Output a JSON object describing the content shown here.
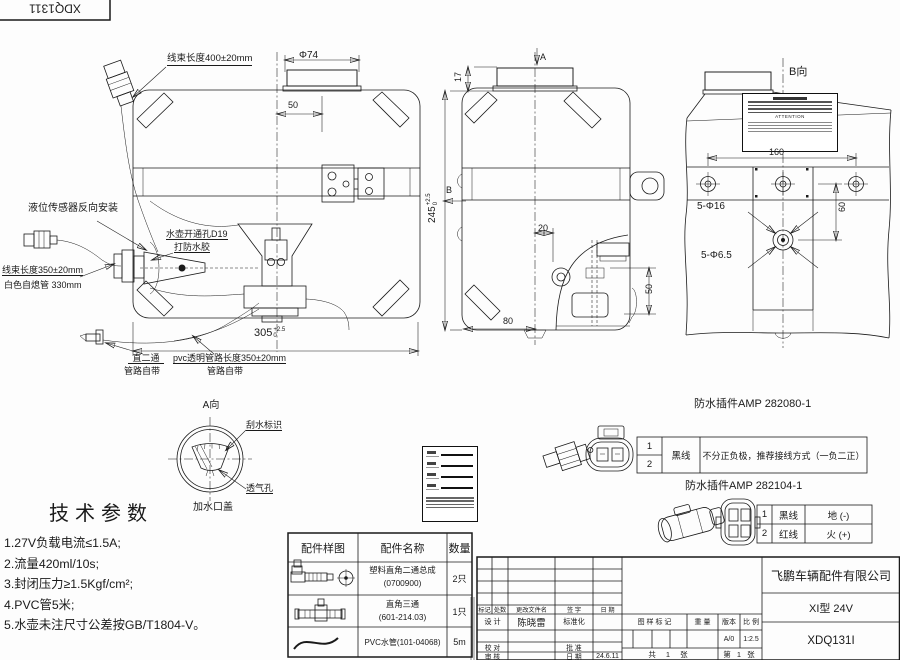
{
  "sheet": {
    "code_top": "XDQ1311"
  },
  "front_view": {
    "harness_top": "线束长度400±20mm",
    "dim_phi74": "Φ74",
    "dim_50": "50",
    "sensor_note": "液位传感器反向安装",
    "hole_note1": "水壶开通孔D19",
    "hole_note2": "打防水胶",
    "harness_left": "线束长度350±20mm",
    "white_tube": "白色自熄管 330mm",
    "elbow_note1": "直二通",
    "elbow_note2": "管路自带",
    "pvc_note1": "pvc透明管路长度350±20mm",
    "pvc_note2": "管路自带",
    "dim_305": "305",
    "dim_305_tol_up": "+2.5",
    "dim_305_tol_dn": "0"
  },
  "side_view": {
    "label_a": "A",
    "label_b": "B",
    "dim_17": "17",
    "dim_245": "245",
    "dim_245_tol_up": "+2.5",
    "dim_245_tol_dn": "0",
    "dim_20": "20",
    "dim_50": "50",
    "dim_80": "80"
  },
  "b_view": {
    "title": "B向",
    "dim_160": "160",
    "dim_60": "60",
    "holes_16": "5-Φ16",
    "holes_65": "5-Φ6.5",
    "plate_attention": "ATTENTION"
  },
  "a_view": {
    "title": "A向",
    "wiper": "刮水标识",
    "vent": "透气孔",
    "cap": "加水口盖"
  },
  "tech_params": {
    "title": "技术参数",
    "items": [
      "1.27V负载电流≤1.5A;",
      "2.流量420ml/10s;",
      "3.封闭压力≥1.5Kgf/cm²;",
      "4.PVC管5米;",
      "5.水壶未注尺寸公差按GB/T1804-V。"
    ]
  },
  "parts_table": {
    "headers": [
      "配件样图",
      "配件名称",
      "数量"
    ],
    "rows": [
      {
        "name1": "塑料直角二通总成",
        "name2": "(0700900)",
        "qty": "2只"
      },
      {
        "name1": "直角三通",
        "name2": "(601-214.03)",
        "qty": "1只"
      },
      {
        "name1": "PVC水管(101-04068)",
        "name2": "",
        "qty": "5m"
      }
    ]
  },
  "connector1": {
    "title": "防水插件AMP 282080-1",
    "pin1": "1",
    "pin2": "2",
    "wire": "黑线",
    "note": "不分正负极，推荐接线方式（一负二正）"
  },
  "connector2": {
    "title": "防水插件AMP 282104-1",
    "rows": [
      {
        "pin": "1",
        "wire": "黑线",
        "role": "地 (-)"
      },
      {
        "pin": "2",
        "wire": "红线",
        "role": "火 (+)"
      }
    ]
  },
  "title_block": {
    "rev_headers": [
      "标记",
      "处数",
      "更改文件名",
      "签 字",
      "日 期"
    ],
    "design": "设 计",
    "designer": "陈晓雷",
    "standard": "标准化",
    "proof": "校 对",
    "approve": "批 准",
    "audit": "审 核",
    "date": "日 期",
    "date_value": "24.6.11",
    "stamp": "图 样 标 记",
    "weight": "重 量",
    "version": "版本",
    "scale": "比 例",
    "version_value": "A/0",
    "scale_value": "1:2.5",
    "total": "共 1 张",
    "sheet_no": "第 1 张",
    "company": "飞鹏车辆配件有限公司",
    "model": "XI型 24V",
    "code": "XDQ131I"
  }
}
